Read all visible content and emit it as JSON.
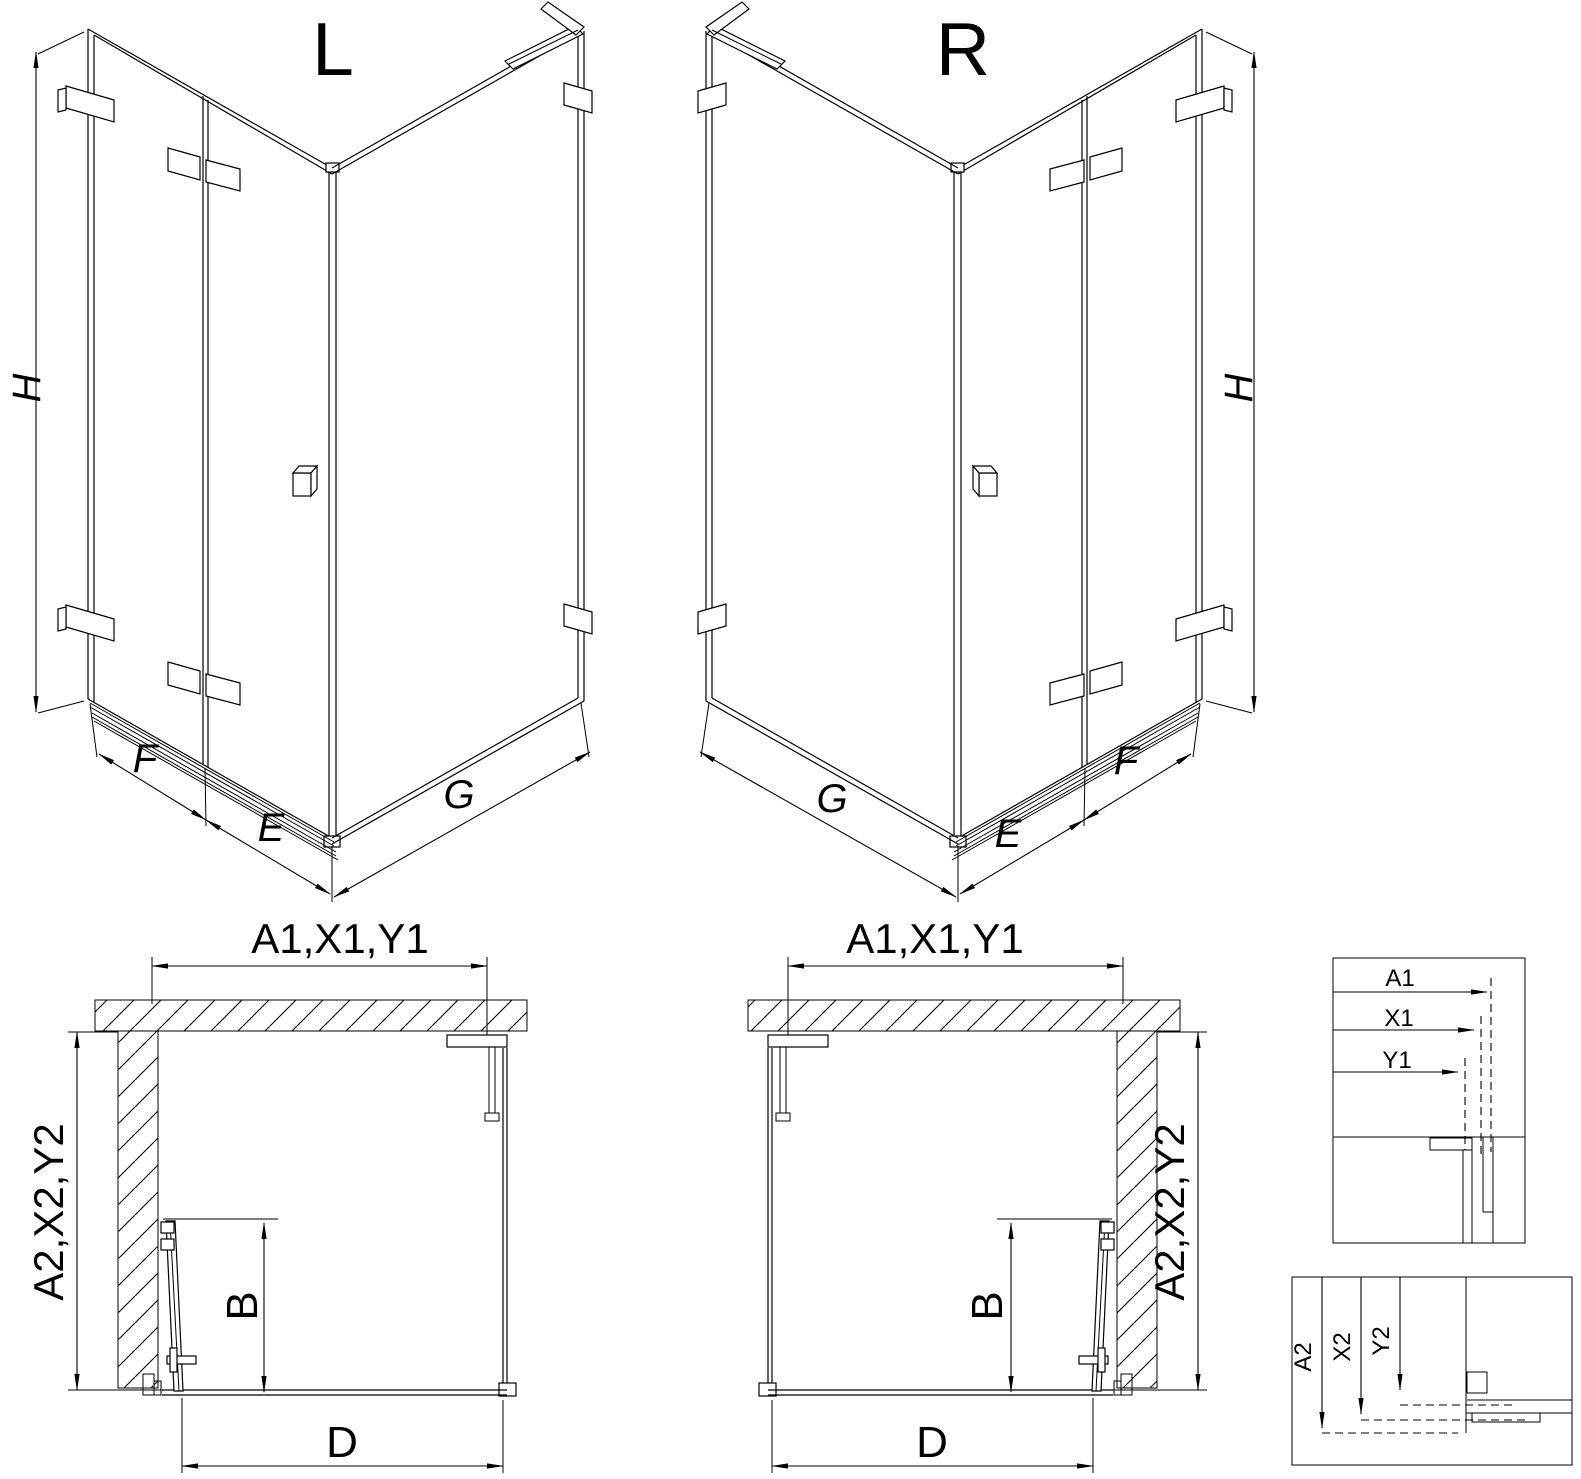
{
  "drawing": {
    "variant_left": {
      "title": "L",
      "height_label": "H",
      "fixed_panel_label": "F",
      "door_panel_label": "E",
      "side_wall_label": "G",
      "plan": {
        "width_label": "A1,X1,Y1",
        "depth_label": "A2,X2,Y2",
        "entry_label": "B",
        "side_label": "D"
      }
    },
    "variant_right": {
      "title": "R",
      "height_label": "H",
      "fixed_panel_label": "F",
      "door_panel_label": "E",
      "side_wall_label": "G",
      "plan": {
        "width_label": "A1,X1,Y1",
        "depth_label": "A2,X2,Y2",
        "entry_label": "B",
        "side_label": "D"
      }
    },
    "detail_width": {
      "labels": [
        "A1",
        "X1",
        "Y1"
      ]
    },
    "detail_depth": {
      "labels": [
        "A2",
        "X2",
        "Y2"
      ]
    },
    "colors": {
      "line": "#000000",
      "background": "#ffffff"
    }
  }
}
